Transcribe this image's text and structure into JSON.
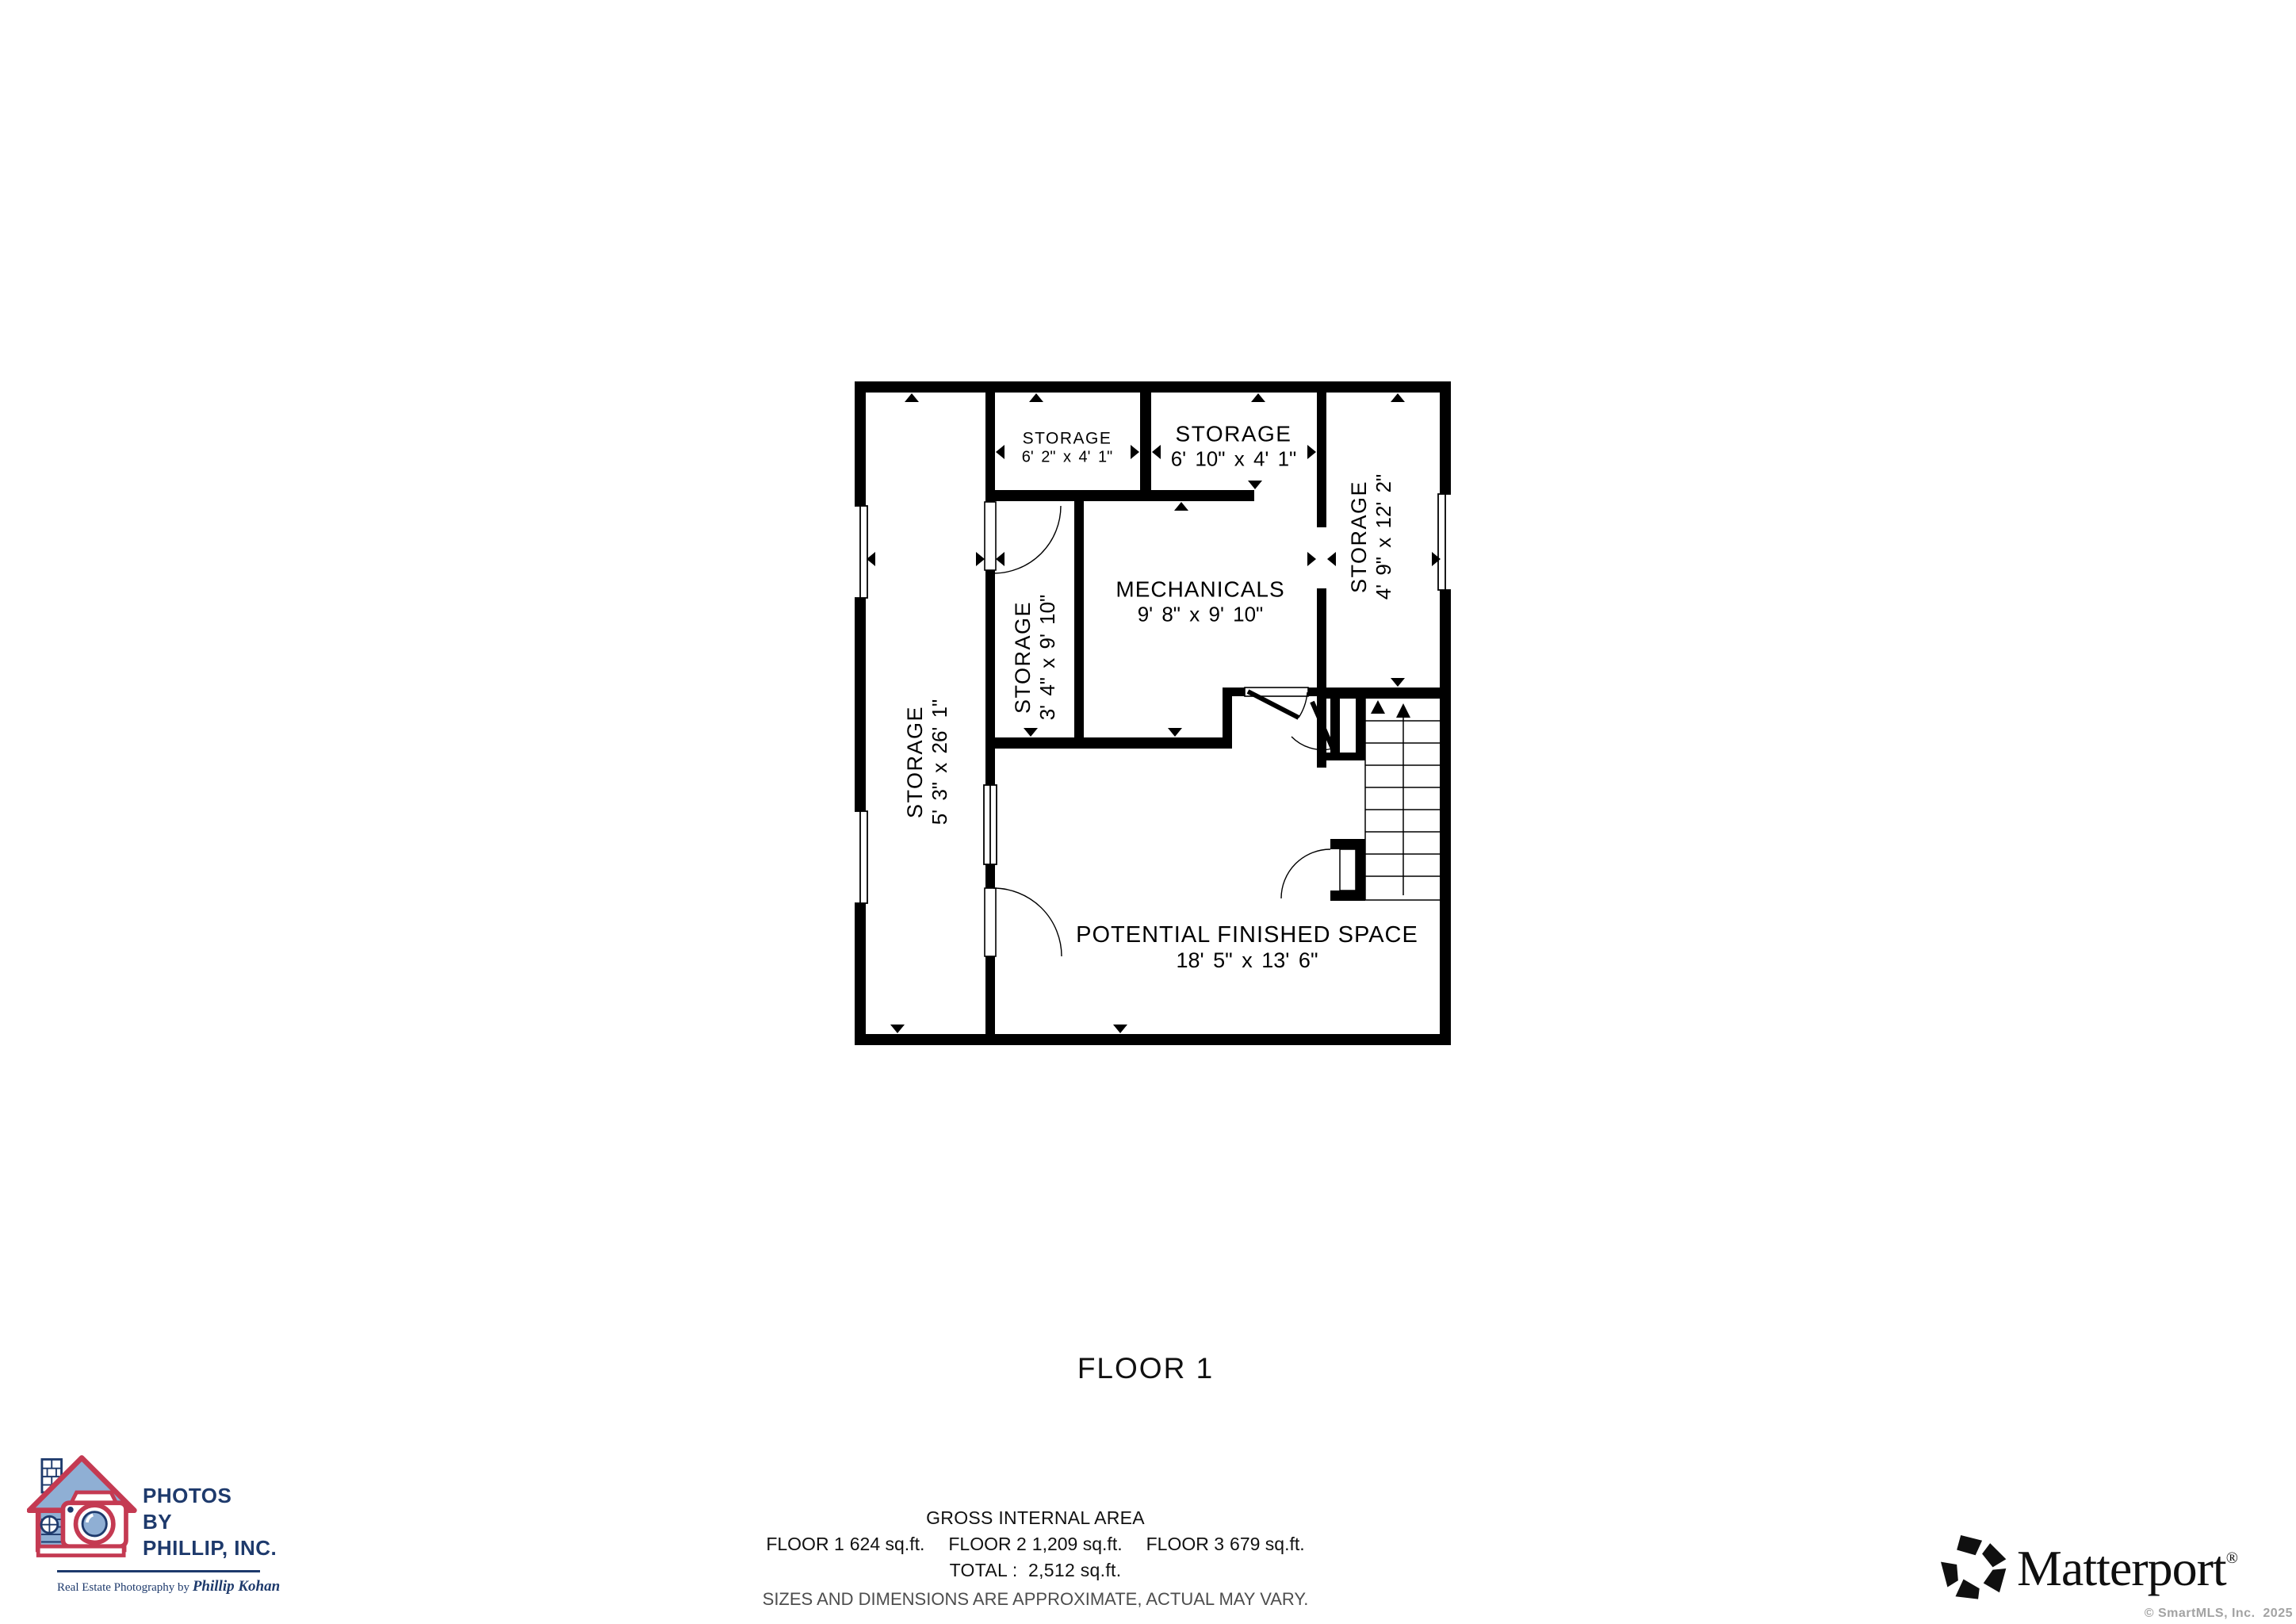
{
  "floor_plan": {
    "rooms": {
      "storage_left": {
        "name": "STORAGE",
        "dims": "5' 3\" x 26' 1\""
      },
      "storage_mid": {
        "name": "STORAGE",
        "dims": "3' 4\" x 9' 10\""
      },
      "storage_top1": {
        "name": "STORAGE",
        "dims": "6' 2\" x 4' 1\""
      },
      "storage_top2": {
        "name": "STORAGE",
        "dims": "6' 10\" x 4' 1\""
      },
      "mechanicals": {
        "name": "MECHANICALS",
        "dims": "9' 8\" x 9' 10\""
      },
      "storage_right": {
        "name": "STORAGE",
        "dims": "4' 9\" x 12' 2\""
      },
      "potential": {
        "name": "POTENTIAL FINISHED SPACE",
        "dims": "18' 5\" x 13' 6\""
      }
    }
  },
  "floor_title": "FLOOR 1",
  "summary": {
    "heading": "GROSS INTERNAL AREA",
    "floors": [
      {
        "label": "FLOOR 1",
        "area": "624 sq.ft."
      },
      {
        "label": "FLOOR 2",
        "area": "1,209 sq.ft."
      },
      {
        "label": "FLOOR 3",
        "area": "679 sq.ft."
      }
    ],
    "total_line": "TOTAL :  2,512 sq.ft.",
    "disclaimer": "SIZES AND DIMENSIONS ARE APPROXIMATE, ACTUAL MAY VARY."
  },
  "photographer_logo": {
    "line1": "PHOTOS",
    "line2": "BY",
    "line3": "PHILLIP, INC.",
    "tagline_prefix": "Real Estate Photography by ",
    "tagline_name": "Phillip Kohan",
    "colors": {
      "navy": "#1e3a6c",
      "red": "#c43a52",
      "blue": "#8fafd4"
    }
  },
  "matterport": {
    "brand": "Matterport",
    "reg": "®",
    "copyright": "© SmartMLS, Inc.  2025"
  }
}
